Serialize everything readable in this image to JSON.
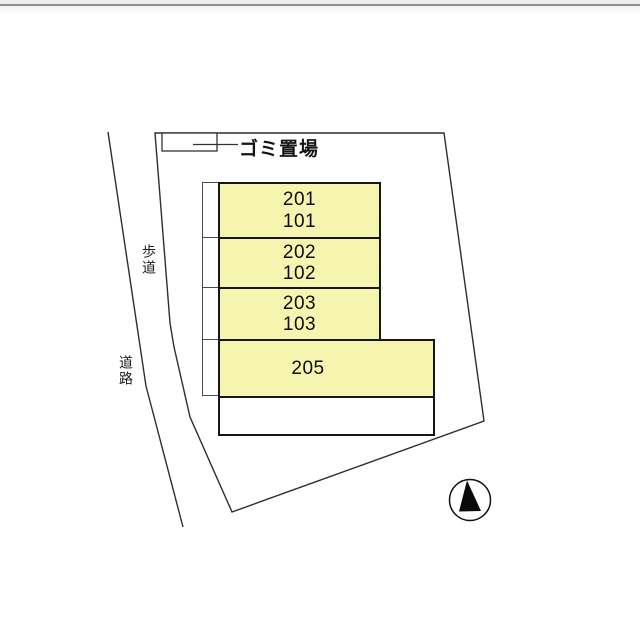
{
  "plan": {
    "garbage_area_label": "ゴミ置場",
    "sidewalk_label": "歩道",
    "road_label": "道路",
    "building": {
      "rooms": [
        {
          "line1": "201",
          "line2": "101"
        },
        {
          "line1": "202",
          "line2": "102"
        },
        {
          "line1": "203",
          "line2": "103"
        },
        {
          "line1": "205",
          "line2": ""
        }
      ]
    },
    "compass": "north-arrow"
  },
  "colors": {
    "room_fill": "#f5f5b0",
    "building_border": "#161616",
    "boundary_line": "#2e2e2e",
    "top_bar": "#ececec",
    "top_bar_line": "#8f8f8f"
  }
}
